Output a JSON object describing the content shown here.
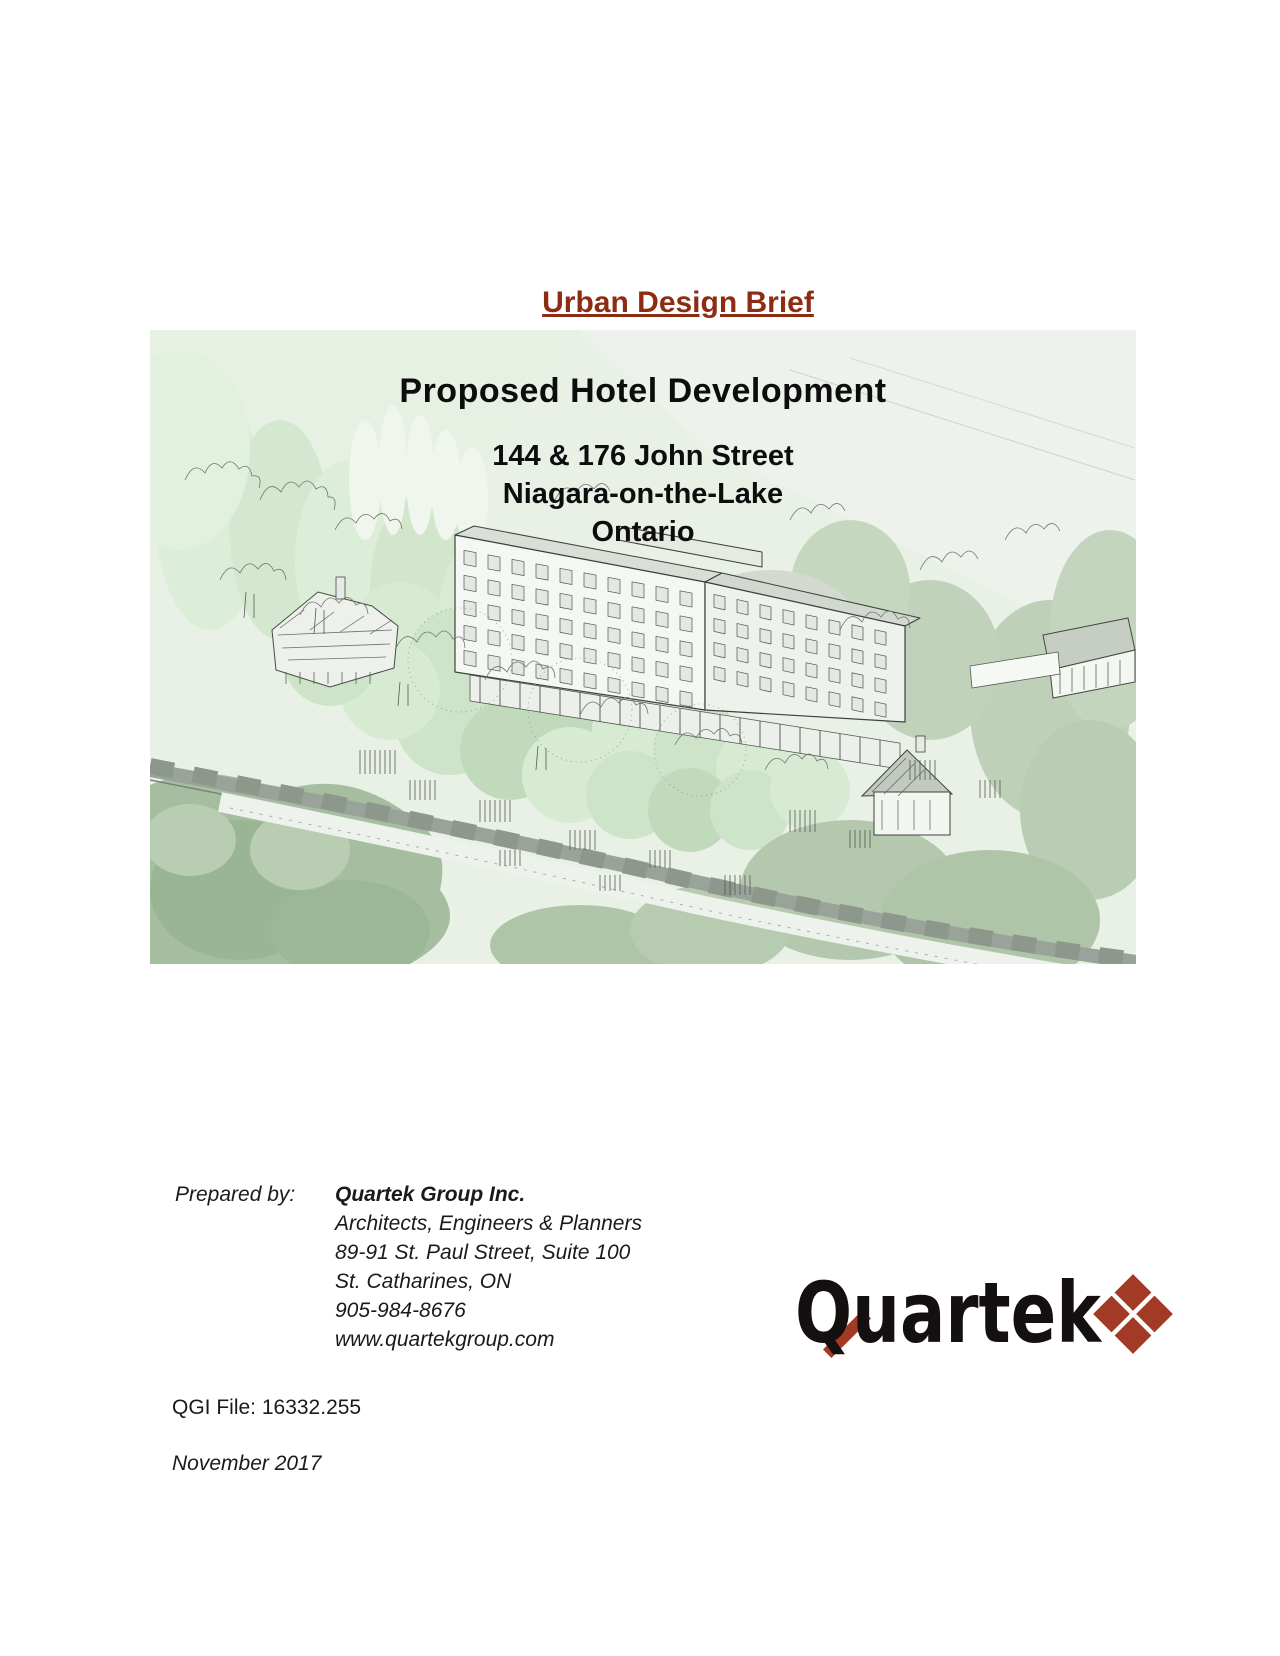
{
  "document": {
    "title": "Urban Design Brief"
  },
  "cover": {
    "headline": "Proposed Hotel Development",
    "address": [
      "144 & 176 John Street",
      "Niagara-on-the-Lake",
      "Ontario"
    ]
  },
  "prepared_by": {
    "label": "Prepared by:",
    "company": "Quartek Group Inc.",
    "details": [
      "Architects, Engineers & Planners",
      "89-91 St. Paul Street, Suite 100",
      "St. Catharines, ON",
      "905-984-8676",
      "www.quartekgroup.com"
    ]
  },
  "logo": {
    "wordmark": "Quartek",
    "accent_color": "#a23a26"
  },
  "footer": {
    "file_number": "QGI File: 16332.255",
    "date": "November 2017"
  },
  "colors": {
    "title_text": "#8e2c13",
    "headline_text": "#0d0d0d",
    "illustration_background": "#e9f1e7",
    "foliage_dark": "#a5be9f",
    "foliage_light": "#d7ebd3"
  }
}
